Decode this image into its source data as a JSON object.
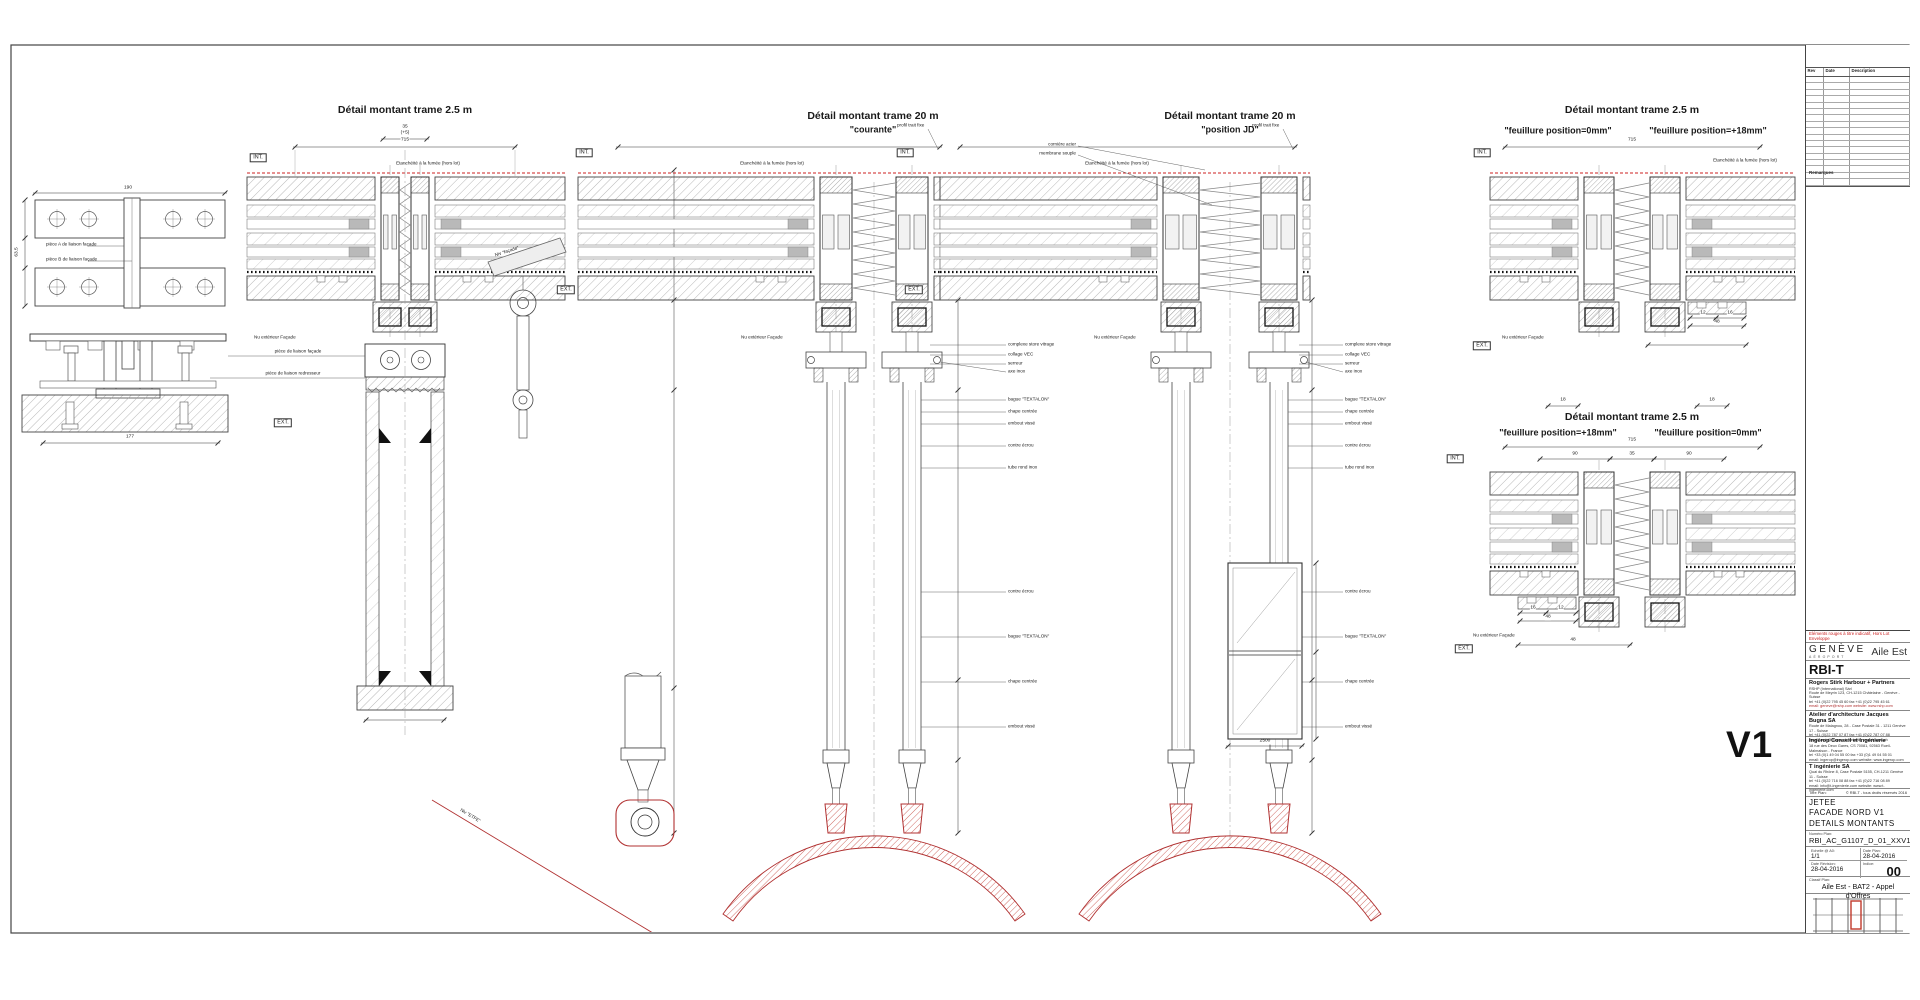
{
  "details": {
    "d1": {
      "title": "Détail montant trame 2.5 m"
    },
    "d2": {
      "title": "Détail montant trame 20 m",
      "subtitle": "\"courante\""
    },
    "d3": {
      "title": "Détail montant trame 20 m",
      "subtitle": "\"position JD\""
    },
    "d4": {
      "title": "Détail montant trame 2.5 m",
      "sub_left": "\"feuillure position=0mm\"",
      "sub_right": "\"feuillure position=+18mm\""
    },
    "d5": {
      "title": "Détail montant trame 2.5 m",
      "sub_left": "\"feuillure position=+18mm\"",
      "sub_right": "\"feuillure position=0mm\""
    }
  },
  "markers": {
    "int": "INT.",
    "ext": "EXT."
  },
  "labels": {
    "nu_ext": "Nu extérieur Façade",
    "etancheite": "Etanchéité à la fumée (hors lot)",
    "profil_fixe": "profil trait fixe",
    "corniere": "cornière acier",
    "membrane": "membrane souple",
    "piece_a": "pièce A de liaison façade",
    "piece_b": "pièce B de liaison façade",
    "liaison_facade": "pièce de liaison façade",
    "liaison_redresseur": "pièce de liaison redresseur",
    "niv_facade": "Niv \"façade\"",
    "niv_etfe": "Niv \"ETFE\""
  },
  "annotations": {
    "upper": [
      "complexe store vitrage",
      "collage VEC",
      "serreur"
    ],
    "axe": "axe inox",
    "mid": [
      "bague \"TEXTALON\"",
      "chape centrée",
      "embout vissé",
      "contre écrou",
      "tube rond inox"
    ],
    "lower": [
      "contre écrou",
      "bague \"TEXTALON\"",
      "chape centrée",
      "embout vissé"
    ]
  },
  "dims": {
    "d715": "715",
    "d35": "35",
    "dp5": "(+5)",
    "d90": "90",
    "d18": "18",
    "d12": "12",
    "d16": "16",
    "d48": "48",
    "d190": "190",
    "d63": "63.5",
    "d177": "177",
    "d2500": "2500"
  },
  "colors": {
    "accent_red": "#cc2222",
    "line_dark": "#333333"
  },
  "revision_table": {
    "headers": [
      "Rev",
      "Date",
      "Description"
    ],
    "remarques": "Remarques"
  },
  "version_mark": "V1",
  "title_block": {
    "disclaimer": "Eléments rouges à titre indicatif, Hors Lot Enveloppe",
    "logo_main": "GENÈVE",
    "logo_sub": "AÉROPORT",
    "project": "Aile Est",
    "code": "RBI-T",
    "firms": [
      {
        "name": "Rogers Stirk Harbour + Partners",
        "lines": [
          "RSHP (International) Sàrl",
          "Route de Meyrin 123, CH-1215 Châtelaine - Genève - Suisse",
          "tel +41 (0)22 795 45 60   fax +41 (0)22 795 45 61",
          "email: geneve@rshp.com   website: www.rshp.com"
        ]
      },
      {
        "name": "Atelier d'architecture Jacques Bugna SA",
        "lines": [
          "Route de Malagnou, 28 - Case Postale 31 - 1211 Genève 17 - Suisse",
          "tel +41 (0)22 787 07 87   fax +41 (0)22 787 07 88",
          "email: arch@bugna.ch   website: www.bugna.ch"
        ]
      },
      {
        "name": "Ingérop Conseil et Ingénierie",
        "lines": [
          "18 rue des Deux Gares, CS 70081, 92563 Rueil-Malmaison - France",
          "tel +33 (0)1 49 04 55 00   fax +33 (0)1 49 04 55 01",
          "email: ingerop@ingerop.com   website: www.ingerop.com"
        ]
      },
      {
        "name": "T ingénierie SA",
        "lines": [
          "Quai du Rhône 8, Case Postale 5155, CH-1211 Genève 11 - Suisse",
          "tel +41 (0)22 716 08 88   fax +41 (0)22 716 08 89",
          "email: info@t-ingenierie.com   website: www.t-ingenierie.com"
        ]
      }
    ],
    "titre_label": "Titre Plan:",
    "copyright": "© RBI-T - tous droits réservés 2016",
    "plan_title": [
      "JETEE",
      "FACADE NORD V1",
      "DETAILS MONTANTS"
    ],
    "numero_label": "Numéro Plan:",
    "numero": "RBI_AC_G1107_D_01_XXV1",
    "echelle_label": "Echelle @ A0:",
    "echelle": "1/1",
    "date_plan_label": "Date Plan:",
    "date_plan": "28-04-2016",
    "date_rev_label": "Date Révision:",
    "date_rev": "28-04-2016",
    "indice_label": "Indice:",
    "indice": "00",
    "classif_label": "Classif Plan:",
    "classif": "Aile Est - BAT2 - Appel d'Offres",
    "legal": "Ne pas mesurer sur le dessin. L'entreprise doit vérifier toutes les cotes et dimensions sur place avant le début des travaux et la mise en fabrication. Toute divergence doit être signalée immédiatement à l'architecte. Ce document est protégé par le droit d'auteur. Toute reproduction, modification ou communication à des tiers sans autorisation écrite préalable est interdite. Les éléments rouges sont donnés à titre indicatif et sont hors lot enveloppe."
  }
}
